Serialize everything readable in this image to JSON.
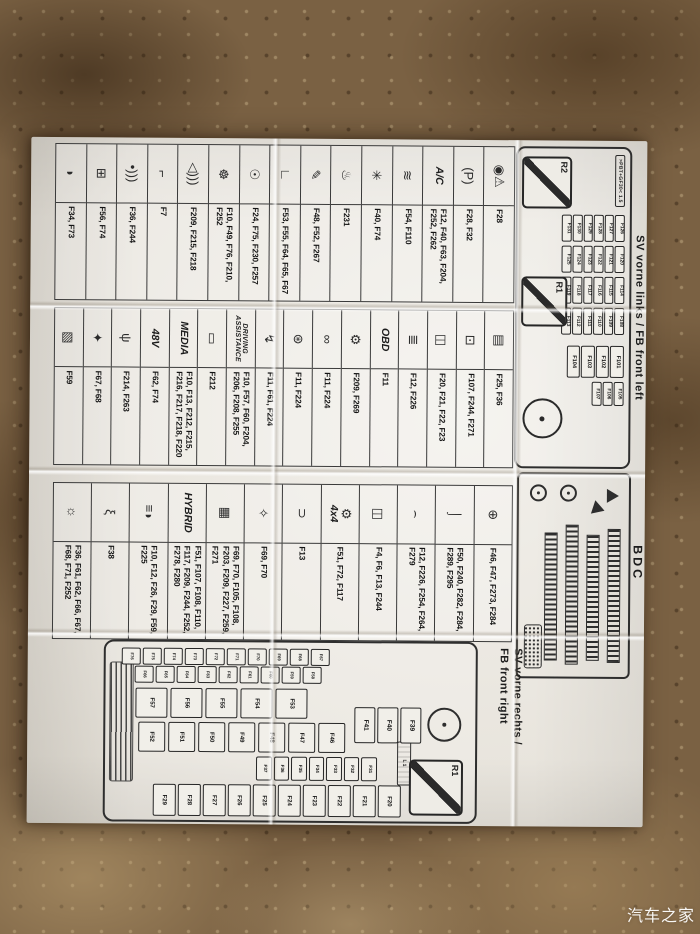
{
  "watermark": "汽车之家",
  "front_left": {
    "heading": "SV vorne links / FB front left",
    "marking": ">PBT+GF30< 1.5",
    "relays": [
      "R2",
      "R1"
    ],
    "fuse_columns": [
      [
        "F126",
        "F127",
        "F128",
        "F129",
        "F130",
        "F131"
      ],
      [
        "F120",
        "F121",
        "F122",
        "F123",
        "F124",
        "F125"
      ],
      [
        "F114",
        "F115",
        "F116",
        "F117",
        "F118",
        "F119"
      ],
      [
        "F108",
        "F109",
        "F110",
        "F111",
        "F112",
        "F113"
      ]
    ],
    "tall_fuses": [
      "F101",
      "F102",
      "F103",
      "F104"
    ],
    "small_fuses": [
      "F105",
      "F106",
      "F107"
    ]
  },
  "bdc": {
    "label": "BDC"
  },
  "front_right": {
    "heading_line1": "SV vorne rechts /",
    "heading_line2": "FB front right",
    "relay": "R1",
    "box_label": "L1",
    "columns": {
      "main": [
        "F20",
        "F21",
        "F22",
        "F23",
        "F24",
        "F25",
        "F26",
        "F27",
        "F28",
        "F29"
      ],
      "mid": [
        "F31",
        "F32",
        "F33",
        "F34",
        "F35",
        "F36",
        "F37"
      ],
      "biga": [
        "F46",
        "F47",
        "F48",
        "F49",
        "F50",
        "F51",
        "F52"
      ],
      "bigb": [
        "F53",
        "F54",
        "F55",
        "F56",
        "F57"
      ],
      "sa": [
        "F67",
        "F68",
        "F69",
        "F70",
        "F71",
        "F72",
        "F73",
        "F74",
        "F75",
        "F76"
      ],
      "sb": [
        "F58",
        "F59",
        "F60",
        "F61",
        "F62",
        "F63",
        "F64",
        "F65",
        "F66"
      ],
      "pow": [
        "F39",
        "F40",
        "F41"
      ]
    }
  },
  "legend": {
    "groups": [
      {
        "rows": [
          {
            "name": "abs-warning-icon",
            "glyph": "◉⚠",
            "fuses": "F28"
          },
          {
            "name": "parking-brake-icon",
            "glyph": "(P)",
            "fuses": "F28, F32"
          },
          {
            "name": "ac-label",
            "label": "A/C",
            "fuses": "F12, F40, F63, F204, F252, F262"
          },
          {
            "name": "rear-defrost-icon",
            "glyph": "≋",
            "fuses": "F54, F110"
          },
          {
            "name": "fan-icon",
            "glyph": "✳",
            "fuses": "F40, F74"
          },
          {
            "name": "heated-seat-icon",
            "glyph": "♨",
            "fuses": "F231"
          },
          {
            "name": "wiper-brush-icon",
            "glyph": "✎",
            "fuses": "F48, F52, F267"
          },
          {
            "name": "door-handle-icon",
            "glyph": "∟",
            "fuses": "F53, F55, F64, F65, F67"
          },
          {
            "name": "seatbelt-icon",
            "glyph": "☉",
            "fuses": "F24, F75, F230, F257"
          },
          {
            "name": "steering-wheel-icon",
            "glyph": "☸",
            "fuses": "F10, F49, F76, F210, F252"
          },
          {
            "name": "horn-icon",
            "glyph": "◁)))",
            "fuses": "F209, F215, F218"
          },
          {
            "name": "pillar-icon",
            "glyph": "⌐",
            "fuses": "F7"
          },
          {
            "name": "antenna-icon",
            "glyph": "•)))",
            "fuses": "F36, F244"
          },
          {
            "name": "control-module-icon",
            "glyph": "⊞",
            "fuses": "F56, F74"
          },
          {
            "name": "headlight-icon",
            "glyph": "◗",
            "fuses": "F34, F73"
          }
        ]
      },
      {
        "rows": [
          {
            "name": "mirror-icon",
            "glyph": "▤",
            "fuses": "F25, F36"
          },
          {
            "name": "display-icon",
            "glyph": "⊡",
            "fuses": "F107, F244, F271"
          },
          {
            "name": "window-lift-icon",
            "glyph": "◫",
            "fuses": "F20, F21, F22, F23"
          },
          {
            "name": "connector-module-icon",
            "glyph": "≣",
            "fuses": "F12, F226"
          },
          {
            "name": "obd-label",
            "label": "OBD",
            "fuses": "F11"
          },
          {
            "name": "gear-icon",
            "glyph": "⚙",
            "fuses": "F209, F269"
          },
          {
            "name": "chain-icon",
            "glyph": "∞",
            "fuses": "F11, F224"
          },
          {
            "name": "engine-pump-icon",
            "glyph": "⊛",
            "fuses": "F11, F224"
          },
          {
            "name": "injector-icon",
            "glyph": "↯",
            "fuses": "F11, F61, F224"
          },
          {
            "name": "driving-assistance-label",
            "label": "DRIVING\nASSISTANCE",
            "fuses": "F10, F57, F60, F204, F206, F208, F255"
          },
          {
            "name": "camera-display-icon",
            "glyph": "▭",
            "fuses": "F212"
          },
          {
            "name": "media-label",
            "label": "MEDIA",
            "fuses": "F10, F13, F212, F215, F216, F217, F218, F220"
          },
          {
            "name": "48v-label",
            "label": "48V",
            "fuses": "F62, F74"
          },
          {
            "name": "usb-icon",
            "glyph": "ψ",
            "fuses": "F214, F263"
          },
          {
            "name": "key-icon",
            "glyph": "✦",
            "fuses": "F67, F68"
          },
          {
            "name": "folding-mirror-icon",
            "glyph": "▧",
            "fuses": "F59"
          }
        ]
      },
      {
        "rows": [
          {
            "name": "diff-lock-icon",
            "glyph": "⊕",
            "fuses": "F46, F47, F273, F284"
          },
          {
            "name": "trailer-hitch-icon",
            "glyph": "⌡",
            "fuses": "F50, F240, F282, F284, F289, F295"
          },
          {
            "name": "convertible-top-icon",
            "glyph": "⌢",
            "fuses": "F12, F226, F254, F264, F279"
          },
          {
            "name": "heated-window-icon",
            "glyph": "◫",
            "fuses": "F4, F6, F13, F244"
          },
          {
            "name": "4x4-label",
            "glyph": "⚙",
            "label": "4x4",
            "fuses": "F51, F72, F117"
          },
          {
            "name": "battery-clamp-icon",
            "glyph": "⊃",
            "fuses": "F13"
          },
          {
            "name": "key2-icon",
            "glyph": "✧",
            "fuses": "F69, F70"
          },
          {
            "name": "engine-icon",
            "glyph": "▦",
            "fuses": "F69, F70, F105, F108, F203, F209, F227, F259, F271"
          },
          {
            "name": "hybrid-label",
            "label": "HYBRID",
            "fuses": "F51, F107, F108, F110, F117, F209, F244, F252, F278, F280"
          },
          {
            "name": "headlight-beam-icon",
            "glyph": "≡◗",
            "fuses": "F10, F12, F26, F29, F59, F225"
          },
          {
            "name": "glow-plug-icon",
            "glyph": "ξ",
            "fuses": "F38"
          },
          {
            "name": "interior-light-icon",
            "glyph": "☼",
            "fuses": "F36, F61, F62, F66, F67, F68, F71, F252"
          }
        ]
      }
    ]
  }
}
